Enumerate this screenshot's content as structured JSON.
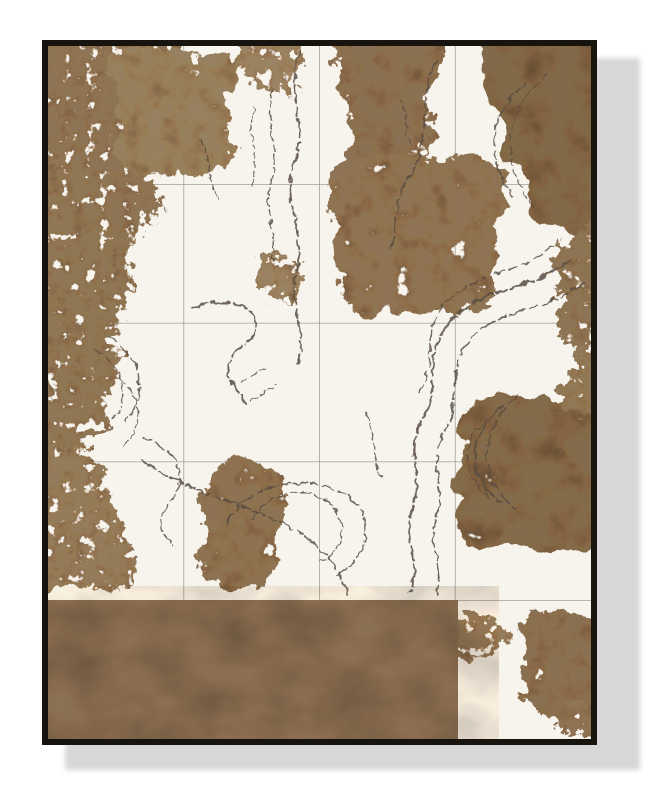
{
  "photo": {
    "alt": "Framed abstract wall-art print: gold foliage splotches and dark swirling brush lines on a white canvas made of square tiles, with a solid bronze band across the bottom, in a thin black frame casting a light gray drop shadow on a white wall"
  },
  "artwork": {
    "palette": {
      "background": "#ffffff",
      "shadow": "#d7d7d7",
      "frame": "#17130e",
      "canvas": "#f7f4ee",
      "grid_line": "#8d8d87",
      "stroke_ink": "#584c42",
      "bronze_band": "#8b7156"
    },
    "grid": {
      "columns": 4,
      "rows": 5
    },
    "band": {
      "x": 0,
      "y": 554,
      "width": 410,
      "height": 139,
      "fill": "#8b7156"
    },
    "masses": [
      {
        "name": "top-left-main",
        "texture": "f2",
        "fill": "#8e7456",
        "d": "M-16 -16 L120 -12 C144 22 100 46 126 70 C150 94 84 106 108 142 C130 174 64 188 84 226 C100 256 48 270 60 294 C44 304 14 300 -16 292 Z"
      },
      {
        "name": "top-left-lobe",
        "texture": "f1",
        "fill": "#97805f",
        "d": "M62 6 C108 -6 146 18 188 10 C200 42 162 58 184 92 C198 120 152 136 122 126 C88 140 58 120 70 90 C78 64 52 36 62 6 Z"
      },
      {
        "name": "top-center-dots",
        "texture": "f2",
        "fill": "#9a8264",
        "d": "M196 -8 C214 -16 232 -6 252 -10 C258 12 240 24 246 42 C228 52 206 44 198 30 C192 18 194 4 196 -8 Z"
      },
      {
        "name": "top-mid",
        "texture": "f1",
        "fill": "#8b7153",
        "d": "M290 -16 L390 -14 C404 30 362 52 386 80 C402 106 344 114 356 142 C324 156 292 138 304 110 C314 82 276 30 290 -16 Z"
      },
      {
        "name": "top-right-corner",
        "texture": "f3",
        "fill": "#82694b",
        "d": "M412 -16 L559 -16 L559 184 C506 198 472 176 482 150 C490 126 442 120 456 94 C468 70 424 56 438 30 C446 12 426 4 412 -16 Z"
      },
      {
        "name": "right-strip-upper",
        "texture": "f2",
        "fill": "#8d7456",
        "d": "M559 170 L559 300 C518 310 500 288 512 264 C522 242 494 232 508 206 C518 188 538 178 559 170 Z"
      },
      {
        "name": "center-right",
        "texture": "f1",
        "fill": "#8e7455",
        "d": "M300 116 C342 96 382 124 422 110 C458 118 470 152 446 178 C464 204 432 228 448 254 C422 278 372 258 340 270 C304 280 280 250 294 222 C268 200 298 184 284 158 C272 136 286 126 300 116 Z"
      },
      {
        "name": "right-low-block",
        "texture": "f3",
        "fill": "#846b4d",
        "d": "M428 356 C468 340 510 360 559 350 L559 500 C508 516 470 490 444 502 C414 512 398 478 414 452 C394 428 430 414 410 388 C400 370 414 362 428 356 Z"
      },
      {
        "name": "right-edge-mid",
        "texture": "f2",
        "fill": "#917858",
        "d": "M559 288 L559 372 C520 380 506 356 516 334 C524 316 540 298 559 288 Z"
      },
      {
        "name": "center-low",
        "texture": "f1",
        "fill": "#8d7354",
        "d": "M176 416 C206 400 232 424 236 450 C246 478 214 490 228 514 C236 538 204 552 178 542 C152 534 146 506 160 486 C144 462 158 434 176 416 Z"
      },
      {
        "name": "left-low-trees",
        "texture": "f2",
        "fill": "#947b5c",
        "d": "M-16 400 C36 392 62 416 56 444 C82 458 64 488 86 506 C102 526 76 548 44 542 C16 537 0 550 -16 550 Z"
      },
      {
        "name": "left-mid-column",
        "texture": "f2",
        "fill": "#8f7657",
        "d": "M-16 114 C42 108 72 134 58 164 C86 184 50 210 74 236 C92 258 54 280 70 306 C84 330 48 346 60 372 C68 396 24 410 -16 400 Z"
      },
      {
        "name": "bottom-right-cluster",
        "texture": "f1",
        "fill": "#8a7052",
        "d": "M488 568 C520 556 544 572 559 582 L559 662 C524 684 488 674 478 650 C468 628 488 612 474 594 C466 582 476 574 488 568 Z"
      },
      {
        "name": "bottom-center-dots",
        "texture": "f2",
        "fill": "#957c5e",
        "d": "M402 576 C422 564 448 572 462 584 C466 600 446 610 426 613 C406 616 396 598 402 576 Z"
      },
      {
        "name": "mid-left-dot",
        "texture": "f2",
        "fill": "#9a8162",
        "d": "M212 214 C232 202 252 214 256 232 C258 248 240 258 222 254 C206 250 204 228 212 214 Z"
      },
      {
        "name": "bottom-right-tail",
        "texture": "f2",
        "fill": "#8f7557",
        "d": "M518 662 C532 654 548 660 554 674 C550 690 530 696 516 688 C508 682 510 670 518 662 Z"
      }
    ],
    "strokes": [
      {
        "d": "M252 6 C236 48 262 78 246 116 C232 152 260 186 248 226 C240 258 260 288 250 318",
        "w": 2,
        "dash": "18 4 9 3"
      },
      {
        "d": "M226 42 C214 76 234 102 223 136 C215 164 231 192 224 218",
        "w": 1.5,
        "dash": "10 4 5 3"
      },
      {
        "d": "M206 62 C198 88 212 112 204 138",
        "w": 1.2,
        "dash": "6 3"
      },
      {
        "d": "M388 16 C368 56 386 96 360 132 C342 160 352 188 342 204",
        "w": 1.7,
        "dash": "14 4"
      },
      {
        "d": "M478 38 C436 68 440 118 466 150",
        "w": 1.5,
        "dash": "12 3"
      },
      {
        "d": "M500 28 C452 62 454 124 486 162",
        "w": 1.2,
        "dash": "8 4"
      },
      {
        "d": "M522 214 C472 250 432 240 402 276 C374 308 394 342 374 374 C356 404 377 432 364 464 C354 490 374 516 362 546",
        "w": 2.4,
        "dash": "22 5 12 4"
      },
      {
        "d": "M537 236 C490 270 452 260 422 294 C396 324 416 354 396 386 C379 414 399 442 388 472 C379 497 397 522 388 550",
        "w": 1.7,
        "dash": "16 5 8 4"
      },
      {
        "d": "M506 200 C466 230 428 226 398 256 C372 282 390 316 372 346",
        "w": 1.4,
        "dash": "10 4"
      },
      {
        "d": "M145 262 C178 250 206 258 208 278 C210 296 186 300 181 318 C177 334 190 344 198 358",
        "w": 2,
        "dash": "16 4"
      },
      {
        "d": "M60 290 C96 310 100 352 78 376",
        "w": 1.5,
        "dash": "12 4"
      },
      {
        "d": "M48 304 C78 322 82 354 64 374",
        "w": 1.2,
        "dash": "8 3"
      },
      {
        "d": "M70 332 C96 350 96 382 75 400",
        "w": 1.2,
        "dash": "9 3"
      },
      {
        "d": "M95 392 C130 402 142 432 122 456 C106 473 112 488 126 500",
        "w": 1.4,
        "dash": "11 4"
      },
      {
        "d": "M95 415 C140 447 196 456 240 480 C276 499 290 522 300 548",
        "w": 1.8,
        "dash": "15 4 8 3"
      },
      {
        "d": "M194 336 C202 330 210 326 218 322",
        "w": 1.3,
        "dash": "7 3"
      },
      {
        "d": "M204 354 C212 348 220 344 228 340",
        "w": 1.2,
        "dash": "6 3"
      },
      {
        "d": "M455 360 C416 392 420 432 452 456",
        "w": 2.1,
        "dash": "18 4"
      },
      {
        "d": "M470 350 C426 388 430 436 468 462",
        "w": 1.5,
        "dash": "12 4"
      },
      {
        "d": "M441 371 C410 398 415 430 441 451",
        "w": 1.3,
        "dash": "8 3"
      },
      {
        "d": "M152 94 C166 114 157 136 171 154",
        "w": 1.2,
        "dash": "6 3"
      },
      {
        "d": "M352 54 C362 70 354 86 364 100",
        "w": 1.2,
        "dash": "5 3"
      },
      {
        "d": "M318 368 C330 390 322 412 334 432",
        "w": 1.3,
        "dash": "7 3"
      },
      {
        "d": "M178 480 C192 442 252 424 296 448 C330 468 322 514 286 530",
        "w": 1.5,
        "dash": "14 4 7 3"
      },
      {
        "d": "M204 474 C218 446 256 438 280 456 C302 473 298 505 272 516",
        "w": 1.3,
        "dash": "9 3"
      }
    ]
  }
}
